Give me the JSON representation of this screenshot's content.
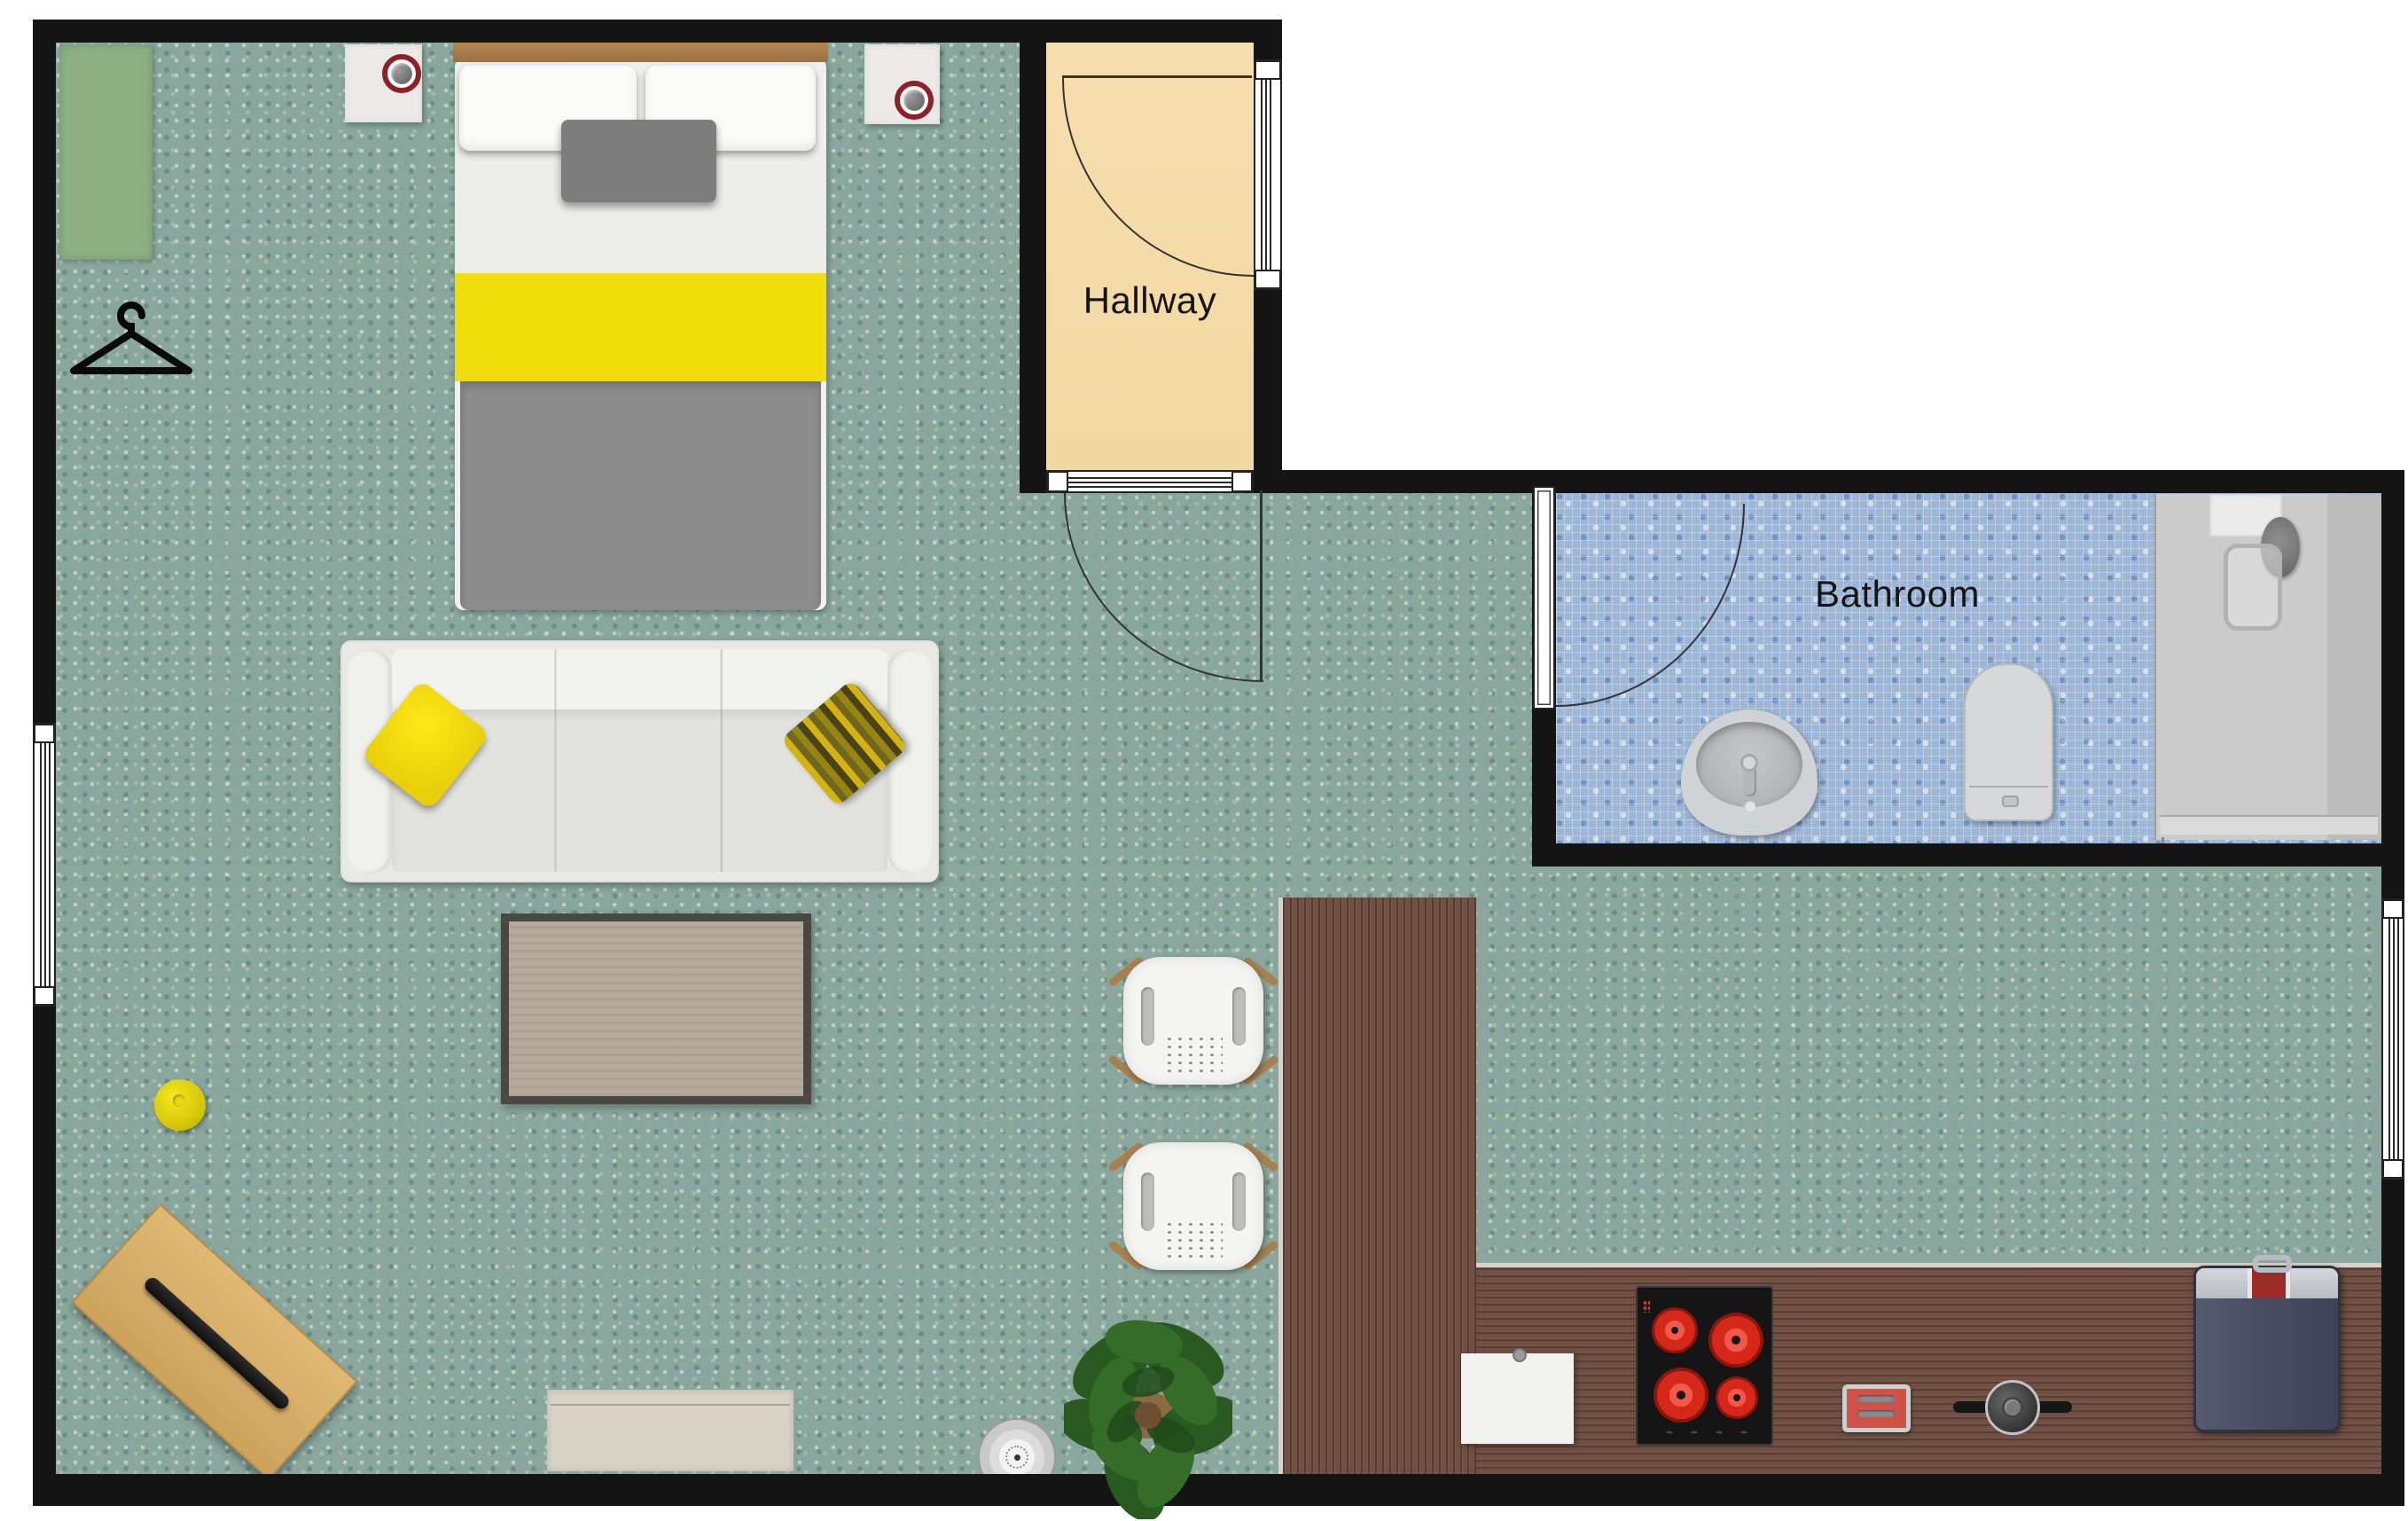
{
  "title": "Studio apartment floor plan",
  "labels": {
    "hallway": "Hallway",
    "bathroom": "Bathroom"
  },
  "palette": {
    "wall": "#141414",
    "main_floor_mosaic": "#8aa79e",
    "hallway_floor": "#f4dcab",
    "bathroom_floor_mosaic": "#9db6d6",
    "counter_wood": "#6f5043",
    "bed_headboard_wood": "#a87c4e",
    "accent_yellow": "#f1dd0c",
    "wardrobe_green": "#8cb084",
    "burner_red": "#d6281a",
    "suitcase_navy": "#4b4f63",
    "lamp_ring_red": "#8e2026"
  },
  "objects": [
    "wardrobe",
    "clothes-hanger",
    "nightstand-with-lamp-left",
    "nightstand-with-lamp-right",
    "double-bed",
    "sofa-with-cushions",
    "coffee-table",
    "yellow-knob",
    "tilted-writing-desk",
    "door-mat",
    "robot-vacuum",
    "potted-plant",
    "bar-chair-1",
    "bar-chair-2",
    "l-shaped-kitchen-counter",
    "sink-cabinet",
    "cooktop-4-burners",
    "toaster",
    "cooking-pot",
    "suitcase",
    "bathroom-sink",
    "toilet",
    "shower-enclosure",
    "hallway-entry-door",
    "living-room-door",
    "bathroom-door",
    "window-left-wall",
    "window-right-wall",
    "window-hallway",
    "hallway-threshold"
  ]
}
